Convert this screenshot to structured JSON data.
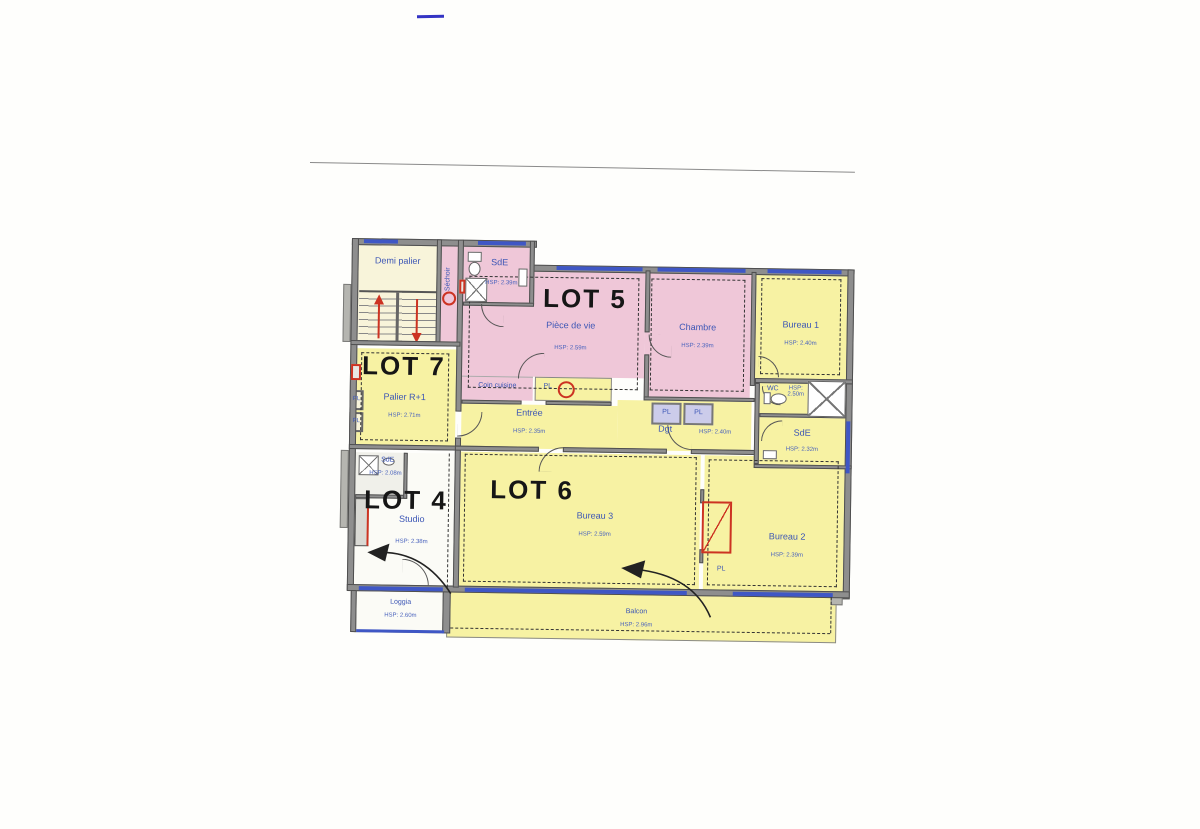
{
  "document": {
    "type": "scanned floor plan",
    "floor": "R+1"
  },
  "plan": {
    "lot_titles": {
      "lot4": "LOT 4",
      "lot5": "LOT 5",
      "lot6": "LOT 6",
      "lot7": "LOT 7"
    },
    "labels": {
      "pl": "PL"
    },
    "rooms": {
      "demi_palier": {
        "name": "Demi palier"
      },
      "sechoir": {
        "name": "Séchoir"
      },
      "sde_lot5": {
        "name": "SdE",
        "hsp": "HSP: 2.39m"
      },
      "piece_de_vie": {
        "name": "Pièce de vie",
        "hsp": "HSP: 2.59m"
      },
      "chambre": {
        "name": "Chambre",
        "hsp": "HSP: 2.39m"
      },
      "bureau1": {
        "name": "Bureau 1",
        "hsp": "HSP: 2.40m"
      },
      "palier": {
        "name": "Palier R+1",
        "hsp": "HSP: 2.71m"
      },
      "coin_cuisine": {
        "name": "Coin cuisine"
      },
      "entree": {
        "name": "Entrée",
        "hsp": "HSP: 2.35m"
      },
      "dgt": {
        "name": "Dgt",
        "hsp": "HSP: 2.40m"
      },
      "wc": {
        "name": "WC",
        "hsp": "HSP: 2.50m"
      },
      "sde_lot6": {
        "name": "SdE",
        "hsp": "HSP: 2.32m"
      },
      "sde_lot4": {
        "name": "SdE",
        "hsp": "HSP: 2.08m"
      },
      "studio": {
        "name": "Studio",
        "hsp": "HSP: 2.38m"
      },
      "bureau3": {
        "name": "Bureau 3",
        "hsp": "HSP: 2.59m"
      },
      "bureau2": {
        "name": "Bureau 2",
        "hsp": "HSP: 2.39m"
      },
      "loggia": {
        "name": "Loggia",
        "hsp": "HSP: 2.60m"
      },
      "balcon": {
        "name": "Balcon",
        "hsp": "HSP: 2.96m"
      }
    },
    "colors": {
      "pink_floor": "#efc7d8",
      "yellow_floor": "#f7f2a3",
      "cream_floor": "#f8f4da",
      "wall_gray": "#8e8e8e",
      "window_blue": "#3f57c5",
      "label_blue": "#3b55b5",
      "red_accent": "#cc3322",
      "lavender_floor": "#ccccea"
    }
  }
}
